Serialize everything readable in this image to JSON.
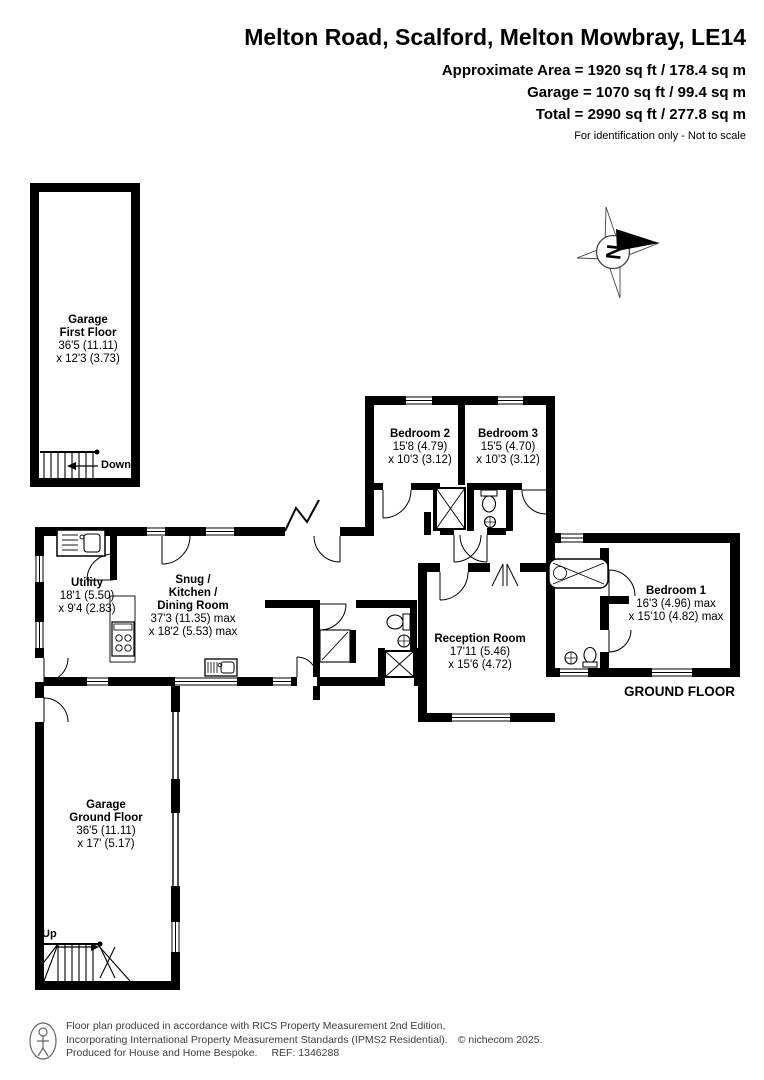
{
  "header": {
    "title": "Melton Road, Scalford, Melton Mowbray, LE14",
    "area_line1": "Approximate Area = 1920 sq ft / 178.4 sq m",
    "area_line2": "Garage = 1070 sq ft / 99.4 sq m",
    "area_line3": "Total = 2990 sq ft / 277.8 sq m",
    "disclaimer": "For identification only - Not to scale"
  },
  "compass": {
    "north_label": "N"
  },
  "labels": {
    "ground_floor": "GROUND FLOOR",
    "stairs_down": "Down",
    "stairs_up": "Up"
  },
  "rooms": {
    "garage_first_floor": {
      "name1": "Garage",
      "name2": "First Floor",
      "dim1": "36'5 (11.11)",
      "dim2": "x 12'3 (3.73)"
    },
    "bedroom2": {
      "name1": "Bedroom 2",
      "dim1": "15'8 (4.79)",
      "dim2": "x 10'3 (3.12)"
    },
    "bedroom3": {
      "name1": "Bedroom 3",
      "dim1": "15'5 (4.70)",
      "dim2": "x 10'3 (3.12)"
    },
    "utility": {
      "name1": "Utility",
      "dim1": "18'1 (5.50)",
      "dim2": "x 9'4 (2.83)"
    },
    "snug_kitchen_dining": {
      "name1": "Snug /",
      "name2": "Kitchen /",
      "name3": "Dining Room",
      "dim1": "37'3 (11.35) max",
      "dim2": "x 18'2 (5.53) max"
    },
    "reception": {
      "name1": "Reception Room",
      "dim1": "17'11 (5.46)",
      "dim2": "x 15'6 (4.72)"
    },
    "bedroom1": {
      "name1": "Bedroom 1",
      "dim1": "16'3 (4.96) max",
      "dim2": "x 15'10 (4.82) max"
    },
    "garage_ground_floor": {
      "name1": "Garage",
      "name2": "Ground Floor",
      "dim1": "36'5 (11.11)",
      "dim2": "x 17' (5.17)"
    }
  },
  "footer": {
    "line1": "Floor plan produced in accordance with RICS Property Measurement 2nd Edition,",
    "line2": "Incorporating International Property Measurement Standards (IPMS2 Residential).",
    "copyright": "© nichecom 2025.",
    "line3": "Produced for House and Home Bespoke.",
    "ref": "REF: 1346288"
  },
  "colors": {
    "wall": "#000000",
    "background": "#ffffff",
    "footer_text": "#3d3d3d"
  }
}
